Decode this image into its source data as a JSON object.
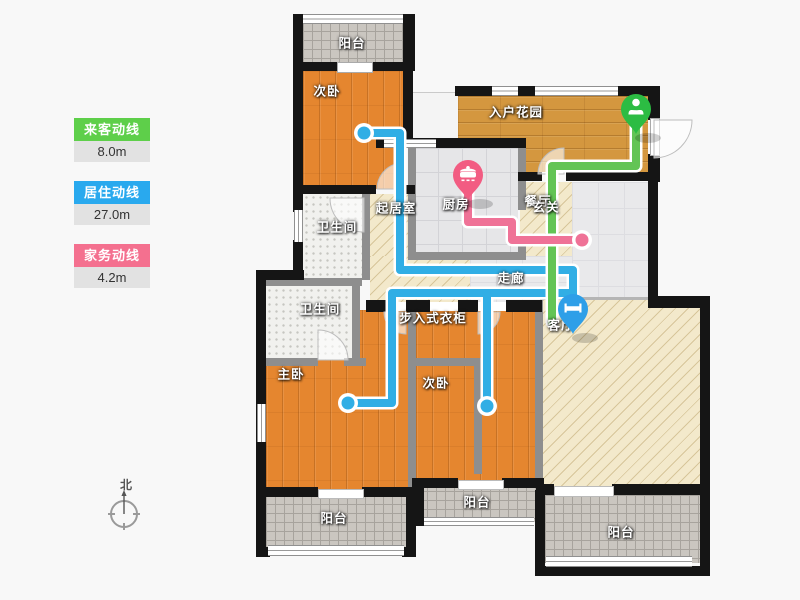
{
  "legend": {
    "items": [
      {
        "id": "guest",
        "label": "来客动线",
        "value": "8.0m",
        "color": "#5ecf4a"
      },
      {
        "id": "residence",
        "label": "居住动线",
        "value": "27.0m",
        "color": "#29a9ee"
      },
      {
        "id": "housework",
        "label": "家务动线",
        "value": "4.2m",
        "color": "#f4708f"
      }
    ]
  },
  "compass": {
    "label": "北"
  },
  "rooms": {
    "balcony_top": "阳台",
    "bedroom_top": "次卧",
    "entry_garden": "入户花园",
    "kitchen": "厨房",
    "dining": "餐厅",
    "foyer": "玄关",
    "inner_hall": "起居室",
    "bathroom_1": "卫生间",
    "bathroom_2": "卫生间",
    "corridor": "走廊",
    "closet": "步入式衣柜",
    "master_bedroom": "主卧",
    "bedroom_bottom": "次卧",
    "living_room": "客厅",
    "balcony_bottom_left": "阳台",
    "balcony_bottom_mid": "阳台",
    "balcony_bottom_right": "阳台"
  },
  "routes": {
    "guest": {
      "name": "来客动线",
      "length": "8.0m",
      "color": "#63c455",
      "pin_color": "#2cbc43",
      "pin_icon": "person-icon"
    },
    "residence": {
      "name": "居住动线",
      "length": "27.0m",
      "color": "#31aee5",
      "pin_color": "#2e9fe8",
      "pin_icon": "bed-icon"
    },
    "housework": {
      "name": "家务动线",
      "length": "4.2m",
      "color": "#ef7297",
      "pin_color": "#f25c82",
      "pin_icon": "pot-icon"
    }
  }
}
